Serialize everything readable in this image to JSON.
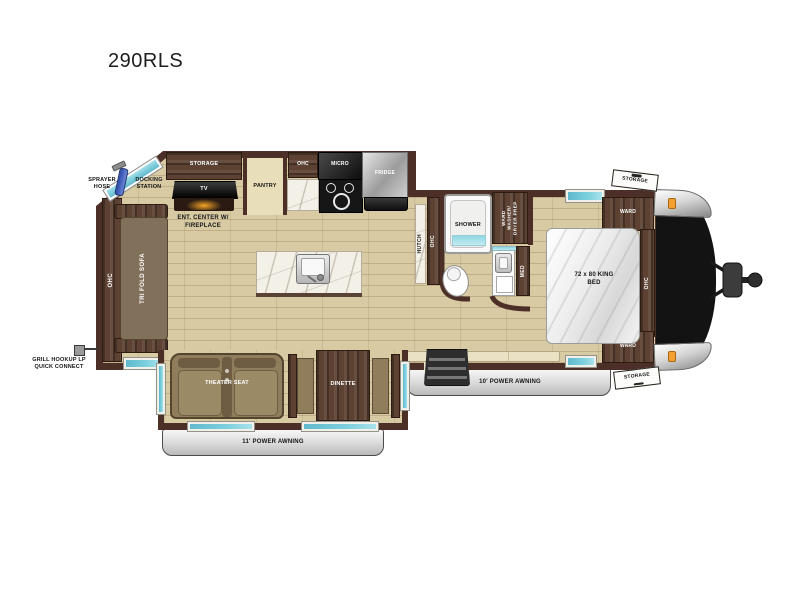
{
  "title": "290RLS",
  "colors": {
    "wall": "#4c2f26",
    "wood": "#5d4233",
    "floor": "#d8cba4",
    "floor-line": "#bfae87",
    "teal": "#7dd0de",
    "amber": "#f2a132",
    "cap": "#131313"
  },
  "exterior": {
    "sprayer_hose": "SPRAYER HOSE",
    "docking_station": "DOCKING STATION",
    "grill_hookup": "GRILL HOOKUP LP QUICK CONNECT",
    "awning_11": "11' POWER AWNING",
    "awning_10": "10' POWER AWNING",
    "storage_front_top": "STORAGE",
    "storage_front_bottom": "STORAGE"
  },
  "living": {
    "ohc_rear": "OHC",
    "tri_fold_sofa": "TRI FOLD SOFA",
    "storage": "STORAGE",
    "tv": "TV",
    "ent_center": "ENT. CENTER W/ FIREPLACE",
    "theater_seat": "THEATER SEAT",
    "dinette": "DINETTE"
  },
  "kitchen": {
    "pantry": "PANTRY",
    "ohc": "OHC",
    "micro": "MICRO",
    "fridge": "FRIDGE",
    "hutch": "HUTCH",
    "hutch_ohc": "OHC"
  },
  "bath": {
    "shower": "SHOWER",
    "ward_wd": "WARD WASHER/ DRYER PREP",
    "med": "MED"
  },
  "bedroom": {
    "ward_top": "WARD",
    "ohc": "OHC",
    "ward_bottom": "WARD",
    "king_bed": "72 x 80 KING BED"
  }
}
